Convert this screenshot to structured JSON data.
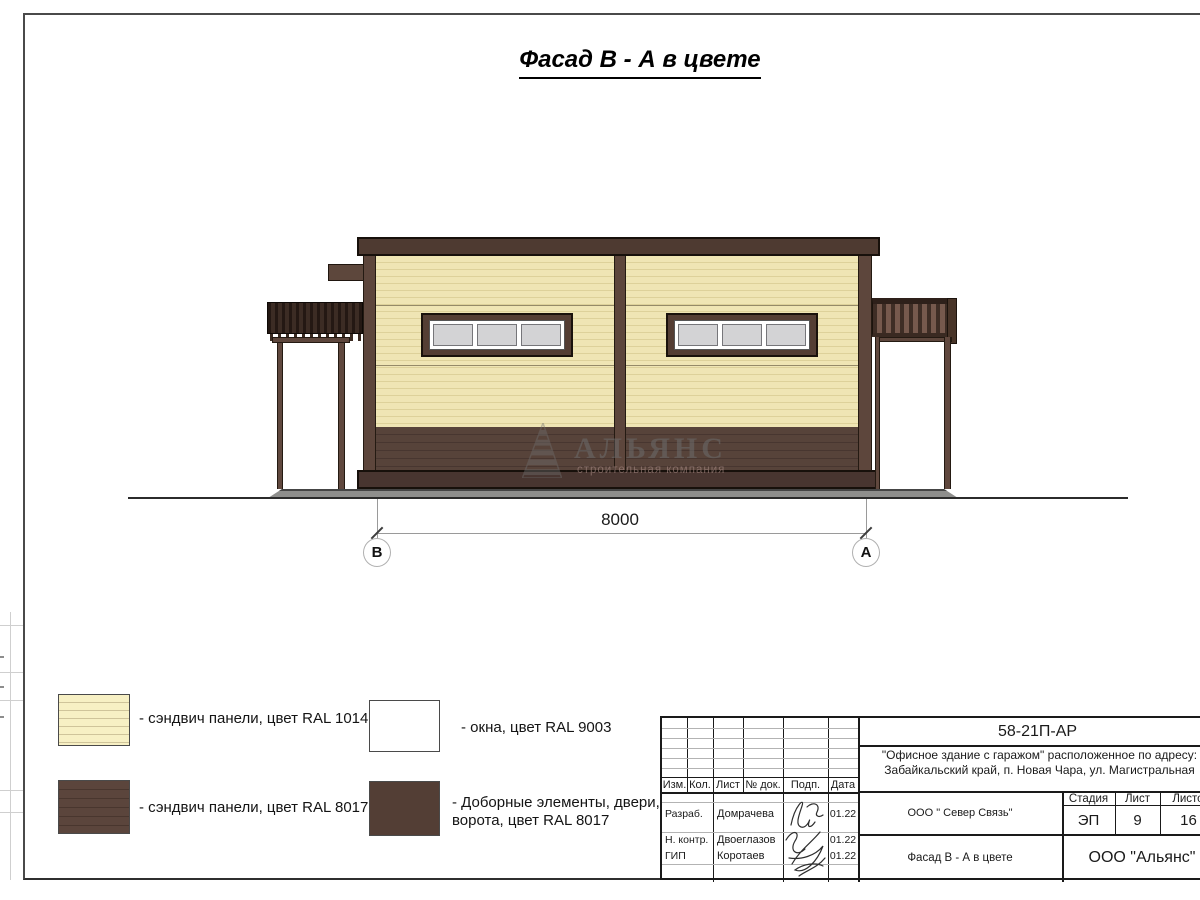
{
  "page_title": "Фасад В - А в цвете",
  "drawing": {
    "dimension": "8000",
    "axis_left": "В",
    "axis_right": "А",
    "watermark_title": "АЛЬЯНС",
    "watermark_subtitle": "строительная компания"
  },
  "legend": {
    "item1_label": "- сэндвич панели, цвет RAL 1014",
    "item2_label": "- сэндвич панели, цвет RAL 8017",
    "item3_label": "- окна, цвет RAL 9003",
    "item4_label_line1": "- Доборные элементы, двери,",
    "item4_label_line2": "ворота, цвет RAL 8017"
  },
  "titleblock": {
    "doc_number": "58-21П-АР",
    "address_line1": "\"Офисное здание с гаражом\" расположенное по адресу:",
    "address_line2": "Забайкальский край, п. Новая Чара, ул. Магистральная",
    "headers": [
      "Изм.",
      "Кол.",
      "Лист",
      "№ док.",
      "Подп.",
      "Дата"
    ],
    "rows": [
      {
        "role": "Разраб.",
        "name": "Домрачева",
        "date": "01.22"
      },
      {
        "role": "Н. контр.",
        "name": "Двоеглазов",
        "date": "01.22"
      },
      {
        "role": "ГИП",
        "name": "Коротаев",
        "date": "01.22"
      }
    ],
    "contractor": "ООО \" Север Связь\"",
    "stage_label": "Стадия",
    "sheet_label": "Лист",
    "sheets_label": "Листов",
    "stage": "ЭП",
    "sheet": "9",
    "sheets": "16",
    "drawing_title": "Фасад В - А в цвете",
    "company": "ООО \"Альянс\""
  },
  "colors": {
    "panel_beige_ral1014": "#efe4b2",
    "panel_brown_ral8017": "#55413a",
    "window_white_ral9003": "#ffffff",
    "dark_elements_ral8017": "#4e3a31",
    "window_glass": "#d3d3d5",
    "concrete_pad": "#8e8e8c"
  }
}
